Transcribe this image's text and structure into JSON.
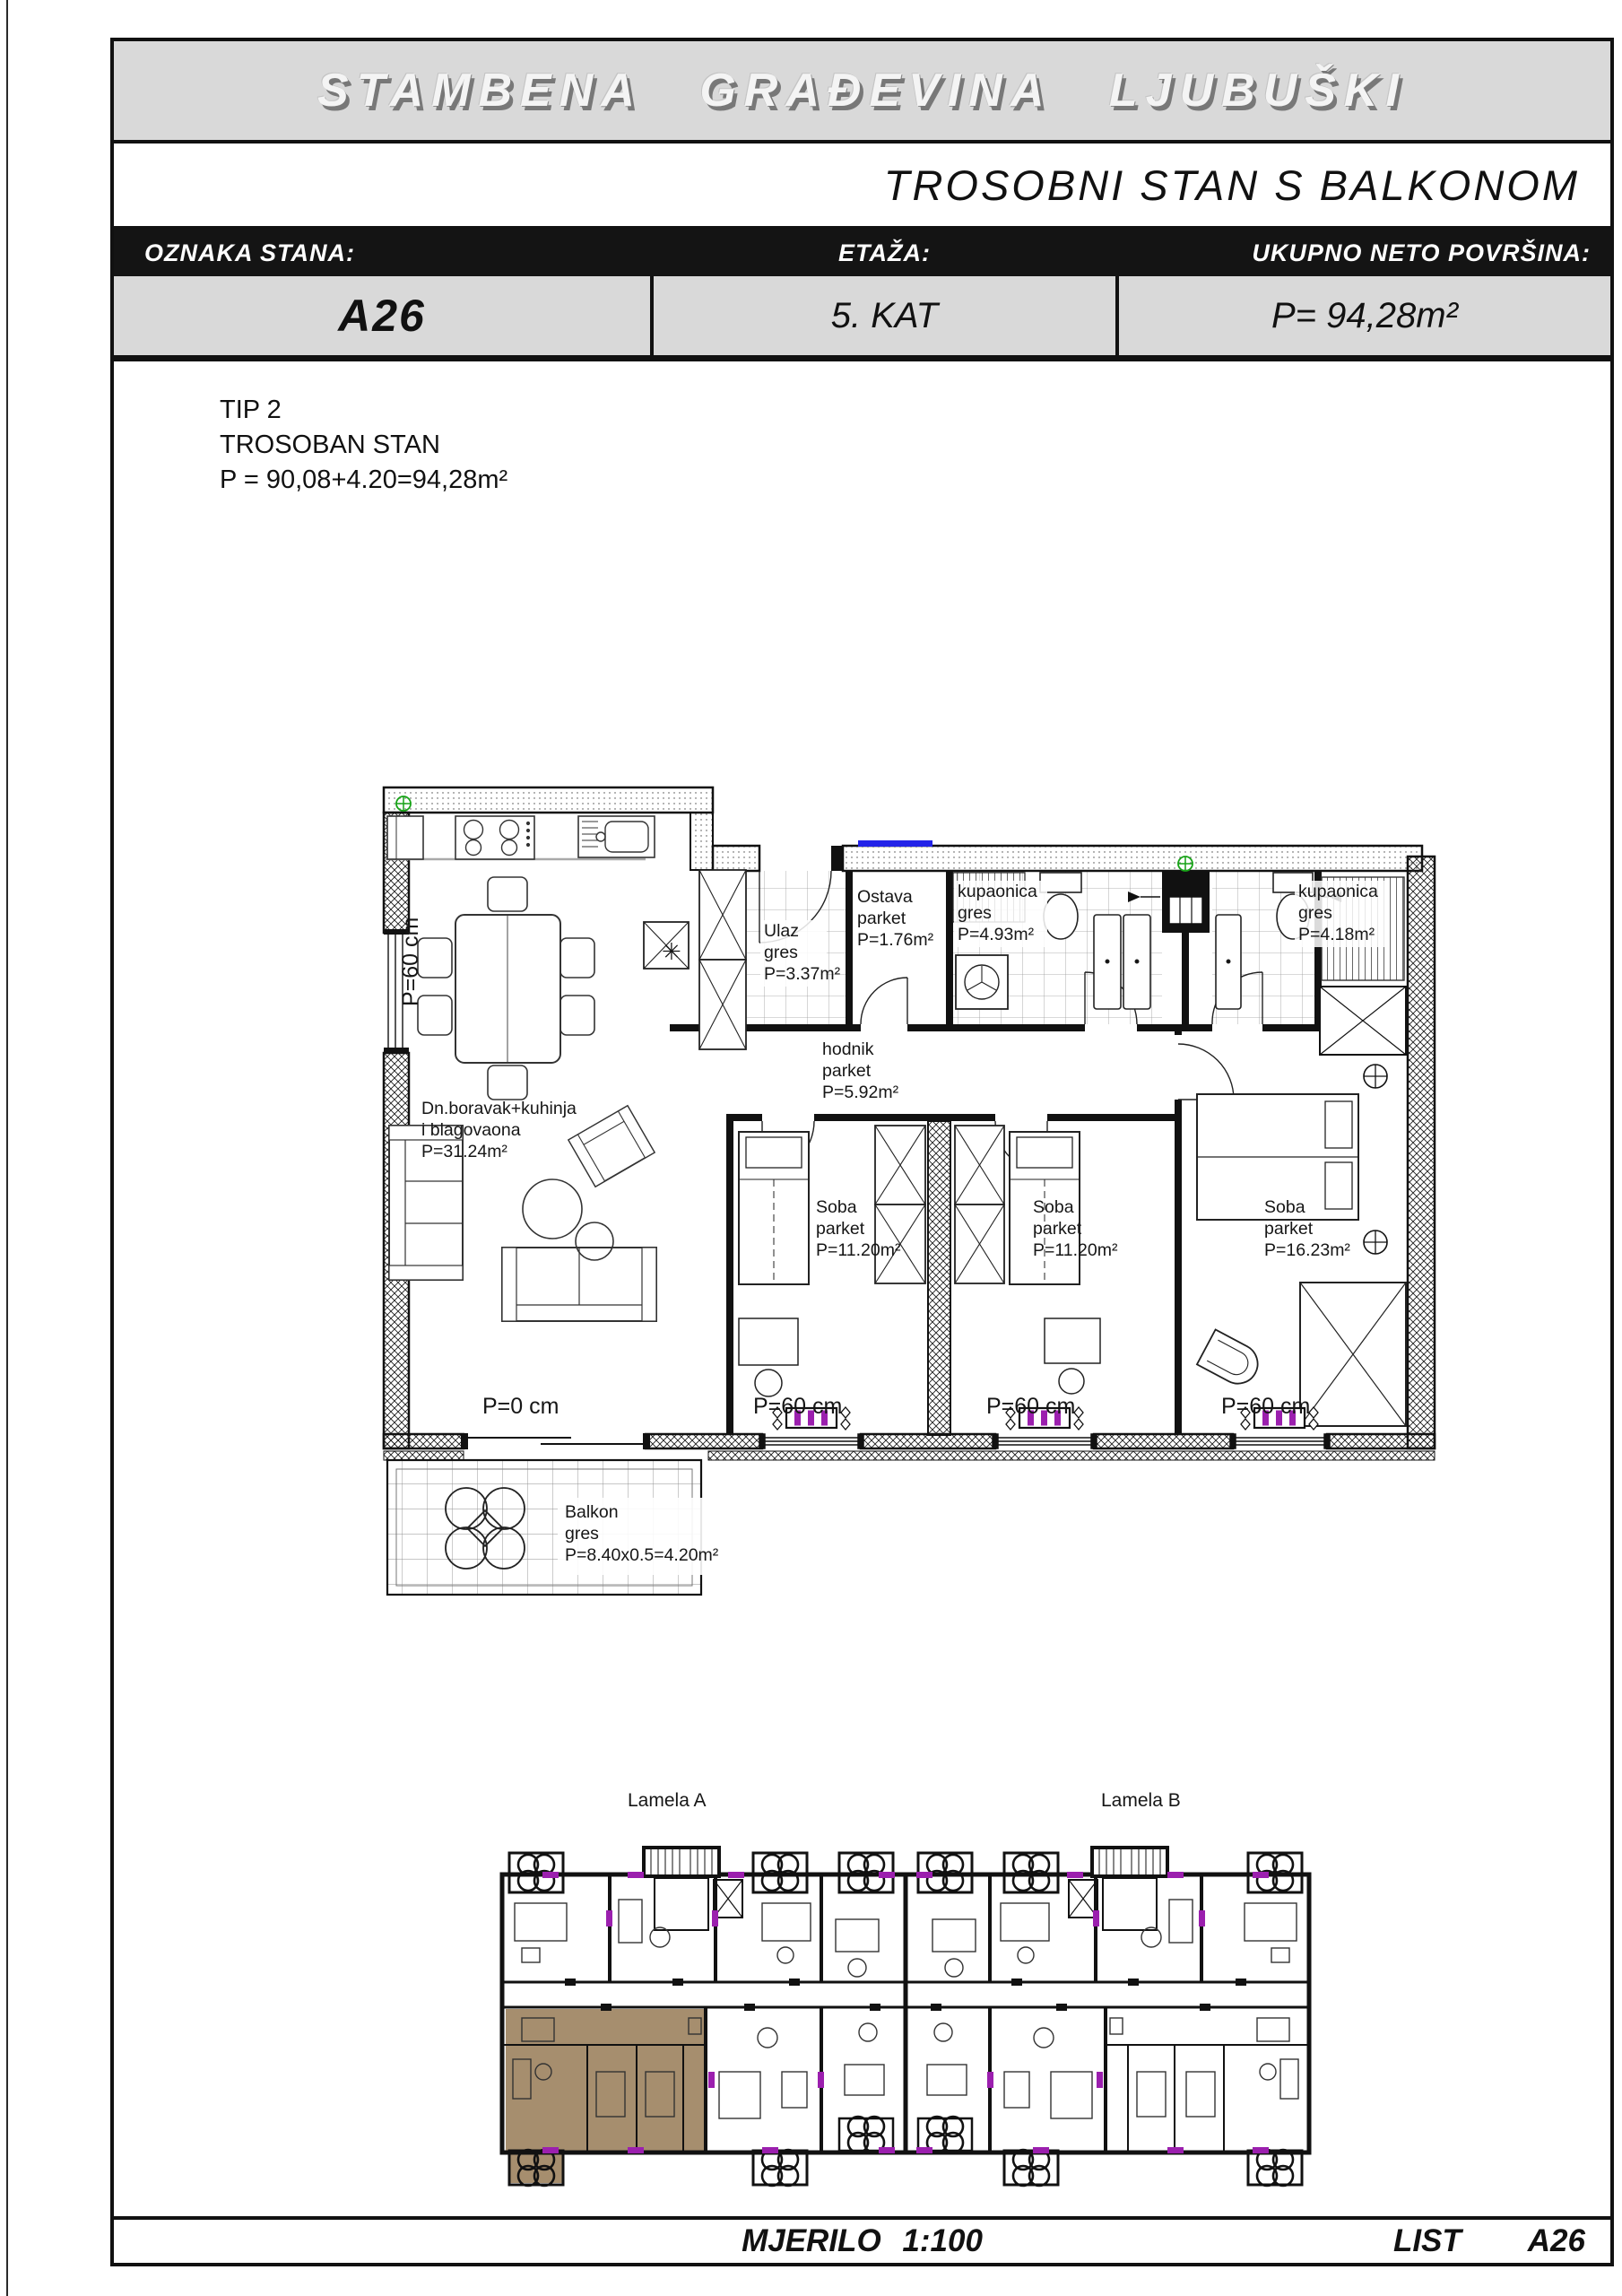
{
  "header": {
    "building_title": "STAMBENA GRAĐEVINA LJUBUŠKI",
    "sheet_title": "TROSOBNI STAN S BALKONOM"
  },
  "spec_table": {
    "columns": [
      {
        "label": "OZNAKA STANA:",
        "value": "A26"
      },
      {
        "label": "ETAŽA:",
        "value": "5. KAT"
      },
      {
        "label": "UKUPNO NETO POVRŠINA:",
        "value": "P= 94,28m²"
      }
    ]
  },
  "info_block": {
    "lines": [
      "TIP 2",
      "TROSOBAN STAN",
      "P = 90,08+4.20=94,28m²"
    ]
  },
  "floor_plan": {
    "rooms": [
      {
        "id": "dnevni-boravak",
        "lines": [
          "Dn.boravak+kuhinja",
          " i blagovaona",
          "P=31.24m²"
        ]
      },
      {
        "id": "ulaz",
        "lines": [
          "Ulaz",
          "gres",
          "P=3.37m²"
        ]
      },
      {
        "id": "ostava",
        "lines": [
          "Ostava",
          "parket",
          "P=1.76m²"
        ]
      },
      {
        "id": "hodnik",
        "lines": [
          "hodnik",
          "parket",
          "P=5.92m²"
        ]
      },
      {
        "id": "kupaonica-1",
        "lines": [
          "kupaonica",
          "gres",
          "P=4.93m²"
        ]
      },
      {
        "id": "kupaonica-2",
        "lines": [
          "kupaonica",
          "gres",
          "P=4.18m²"
        ]
      },
      {
        "id": "soba-1",
        "lines": [
          "Soba",
          "parket",
          "P=11.20m²"
        ]
      },
      {
        "id": "soba-2",
        "lines": [
          "Soba",
          "parket",
          "P=11.20m²"
        ]
      },
      {
        "id": "soba-3",
        "lines": [
          "Soba",
          "parket",
          "P=16.23m²"
        ]
      },
      {
        "id": "balkon",
        "lines": [
          "Balkon",
          "gres",
          "P=8.40x0.5=4.20m²"
        ]
      }
    ],
    "parapets": {
      "left": "P=60 cm",
      "balcony_door": "P=0 cm",
      "window_1": "P=60 cm",
      "window_2": "P=60 cm",
      "window_3": "P=60 cm"
    },
    "symbols": {
      "star": "✳"
    }
  },
  "overview": {
    "lamela_a": "Lamela A",
    "lamela_b": "Lamela B"
  },
  "footer": {
    "scale_label": "MJERILO 1:100",
    "sheet_label": "LIST",
    "sheet_number": "A26"
  },
  "colors": {
    "header_band": "#d9d9d9",
    "table_header_band": "#141414",
    "table_values_band": "#d9d9d9",
    "radiator": "#9b1fae",
    "entry_door": "#2323e8",
    "vent": "#17a317",
    "highlighted_unit": "#a68e6e"
  }
}
